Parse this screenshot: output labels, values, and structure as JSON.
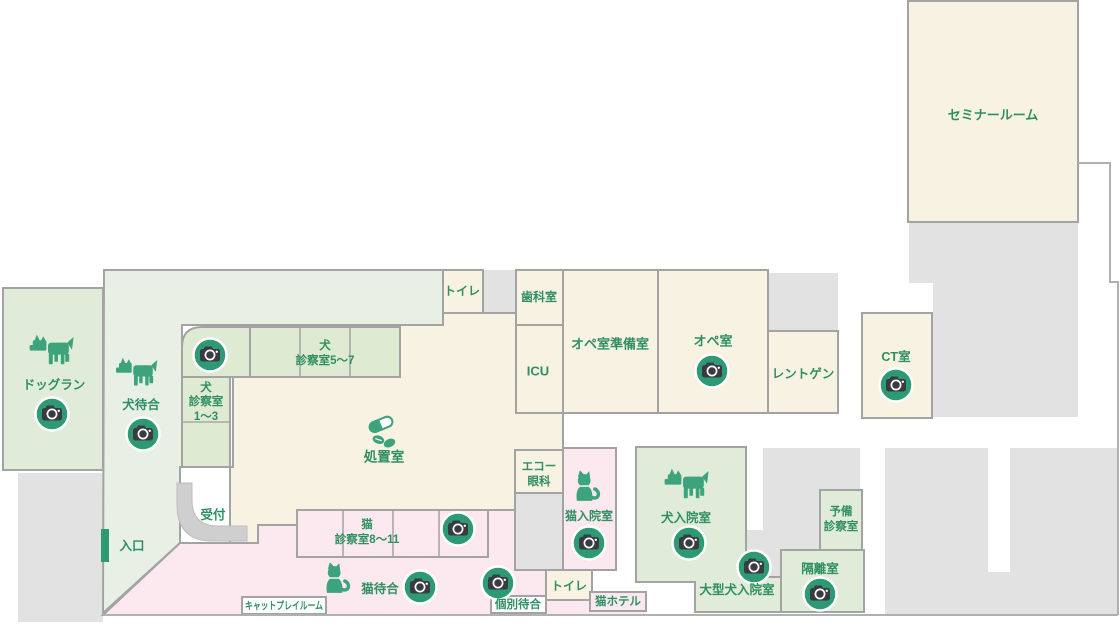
{
  "title": "animal-hospital-floor-plan",
  "palette": {
    "room_beige": "#f8f2e3",
    "zone_green": "#e8f0e5",
    "room_green": "#e0ecd8",
    "cell_green": "#dfead3",
    "zone_pink": "#fce9ef",
    "gray_block": "#e2e2e2",
    "wall_gray": "#a3a3a3",
    "counter_gray": "#cfcfcf",
    "text_green": "#2f8f63",
    "icon_green": "#3ca37c",
    "camera_circle_green": "#2d9a74",
    "camera_body_gray": "#3a3a42"
  },
  "icons": {
    "camera": "photo-camera-spot",
    "dog": "dog-silhouette",
    "cat": "cat-silhouette",
    "pills": "medicine-pills"
  },
  "rooms": {
    "seminar": {
      "label": "セミナールーム"
    },
    "toilet_top": {
      "label": "トイレ"
    },
    "dental": {
      "label": "歯科室"
    },
    "icu": {
      "label": "ICU"
    },
    "ope_prep": {
      "label": "オペ室準備室"
    },
    "ope": {
      "label": "オペ室"
    },
    "xray": {
      "label": "レントゲン"
    },
    "ct": {
      "label": "CT室"
    },
    "dogrun": {
      "label": "ドッグラン"
    },
    "dog_wait": {
      "label": "犬待合"
    },
    "dog_exam_5_7": {
      "lines": [
        "犬",
        "診察室5〜7"
      ]
    },
    "dog_exam_1_3": {
      "lines": [
        "犬",
        "診察室",
        "1〜3"
      ]
    },
    "treatment": {
      "label": "処置室"
    },
    "reception": {
      "label": "受付"
    },
    "entrance": {
      "label": "入口"
    },
    "echo_eye": {
      "lines": [
        "エコー",
        "眼科"
      ]
    },
    "cat_exam_8_11": {
      "lines": [
        "猫",
        "診察室8〜11"
      ]
    },
    "cat_wait": {
      "label": "猫待合"
    },
    "cat_play": {
      "label": "キャットプレイルーム"
    },
    "individual_wait": {
      "label": "個別待合"
    },
    "toilet_bottom": {
      "label": "トイレ"
    },
    "cat_hotel": {
      "label": "猫ホテル"
    },
    "cat_inpatient": {
      "label": "猫入院室"
    },
    "dog_inpatient": {
      "label": "犬入院室"
    },
    "large_dog_inpatient": {
      "label": "大型犬入院室"
    },
    "isolation": {
      "label": "隔離室"
    },
    "spare_exam": {
      "lines": [
        "予備",
        "診察室"
      ]
    }
  }
}
